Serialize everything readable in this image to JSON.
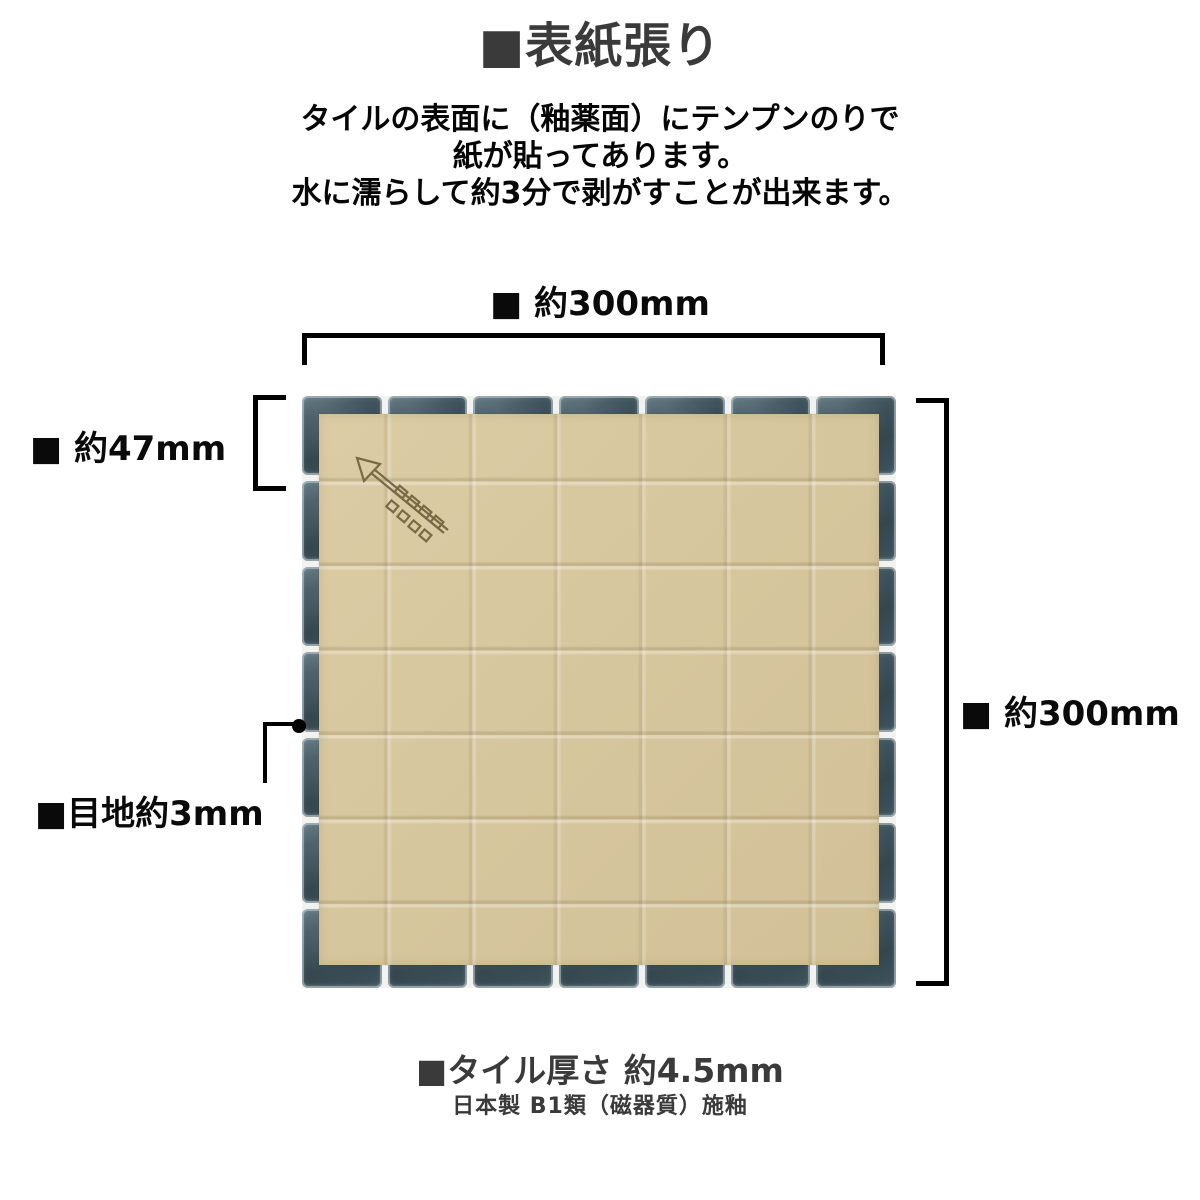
{
  "page": {
    "title": "■表紙張り",
    "description": {
      "line1": "タイルの表面に（釉薬面）にテンプンのりで",
      "line2": "紙が貼ってあります。",
      "line3": "水に濡らして約3分で剥がすことが出来ます。"
    }
  },
  "diagram": {
    "dimensions": {
      "top_width_label": "■ 約300mm",
      "tile_size_label": "■ 約47mm",
      "right_height_label": "■ 約300mm",
      "joint_label": "■目地約3mm"
    },
    "tile_sheet": {
      "rows": 7,
      "cols": 7,
      "covering": "paper face covering with fold creases",
      "mark": "arrow-logo printed on paper"
    },
    "colors": {
      "tile": "#3c5058",
      "tile_highlight": "#8aa0ab",
      "grout": "#f2f2ef",
      "paper": "#d8c8a0",
      "arrow_mark": "#7a6945",
      "dimension_lines": "#000000",
      "title_text": "#3a3a3a",
      "body_text": "#050505"
    }
  },
  "footer": {
    "thickness_label": "■タイル厚さ 約4.5mm",
    "origin_label": "日本製 B1類（磁器質）施釉"
  }
}
